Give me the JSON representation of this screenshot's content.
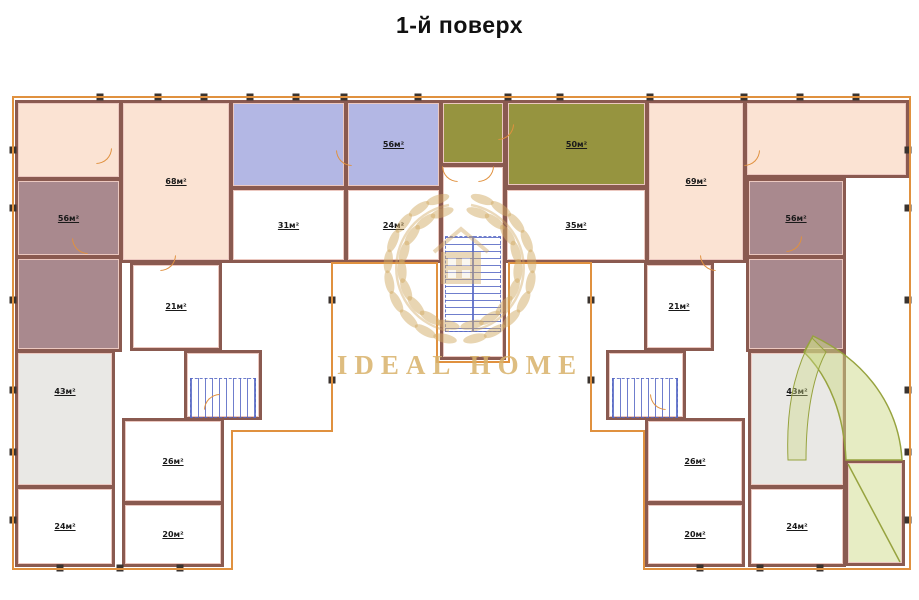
{
  "title": "1-й поверх",
  "watermark": {
    "text": "IDEAL HOME",
    "color": "#d7af68"
  },
  "palette": {
    "peach": "#fbe3d3",
    "blue": "#b3b7e4",
    "olive": "#96943f",
    "mauve": "#a9898e",
    "gray": "#e9e8e5",
    "white": "#ffffff",
    "terrace": "rgba(207,219,138,0.5)",
    "wall": "#8a5a50",
    "outline": "#e0913f",
    "stair_blue": "#5668c4"
  },
  "plan": {
    "rooms": [
      {
        "id": "room-peach-left-top",
        "label": "",
        "x": 15,
        "y": 100,
        "w": 107,
        "h": 80,
        "fill": "peach"
      },
      {
        "id": "room-68",
        "label": "68м²",
        "x": 120,
        "y": 100,
        "w": 112,
        "h": 163,
        "fill": "peach"
      },
      {
        "id": "room-blue-left",
        "label": "",
        "x": 230,
        "y": 100,
        "w": 117,
        "h": 89,
        "fill": "blue"
      },
      {
        "id": "room-56-blue",
        "label": "56м²",
        "x": 345,
        "y": 100,
        "w": 97,
        "h": 89,
        "fill": "blue"
      },
      {
        "id": "room-green-small",
        "label": "",
        "x": 440,
        "y": 100,
        "w": 66,
        "h": 66,
        "fill": "olive"
      },
      {
        "id": "room-50",
        "label": "50м²",
        "x": 505,
        "y": 100,
        "w": 143,
        "h": 88,
        "fill": "olive"
      },
      {
        "id": "room-69",
        "label": "69м²",
        "x": 646,
        "y": 100,
        "w": 100,
        "h": 163,
        "fill": "peach"
      },
      {
        "id": "room-peach-right-top",
        "label": "",
        "x": 744,
        "y": 100,
        "w": 165,
        "h": 78,
        "fill": "peach"
      },
      {
        "id": "room-31",
        "label": "31м²",
        "x": 230,
        "y": 187,
        "w": 117,
        "h": 76,
        "fill": "white"
      },
      {
        "id": "room-24-top",
        "label": "24м²",
        "x": 345,
        "y": 187,
        "w": 97,
        "h": 76,
        "fill": "white"
      },
      {
        "id": "room-35",
        "label": "35м²",
        "x": 504,
        "y": 187,
        "w": 144,
        "h": 76,
        "fill": "white"
      },
      {
        "id": "stair-hall-center",
        "label": "",
        "x": 440,
        "y": 164,
        "w": 66,
        "h": 196,
        "fill": "white"
      },
      {
        "id": "room-56-left",
        "label": "56м²",
        "x": 15,
        "y": 178,
        "w": 107,
        "h": 80,
        "fill": "mauve"
      },
      {
        "id": "room-mauve-left",
        "label": "",
        "x": 15,
        "y": 256,
        "w": 107,
        "h": 96,
        "fill": "mauve"
      },
      {
        "id": "room-43-left",
        "label": "43м²",
        "x": 15,
        "y": 350,
        "w": 100,
        "h": 138,
        "fill": "gray",
        "lt": 26
      },
      {
        "id": "room-24-left",
        "label": "24м²",
        "x": 15,
        "y": 486,
        "w": 100,
        "h": 81,
        "fill": "white"
      },
      {
        "id": "room-21-left",
        "label": "21м²",
        "x": 130,
        "y": 262,
        "w": 92,
        "h": 89,
        "fill": "white"
      },
      {
        "id": "stair-room-left",
        "label": "",
        "x": 184,
        "y": 350,
        "w": 78,
        "h": 70,
        "fill": "white"
      },
      {
        "id": "room-26-left",
        "label": "26м²",
        "x": 122,
        "y": 418,
        "w": 102,
        "h": 86,
        "fill": "white"
      },
      {
        "id": "room-20-left",
        "label": "20м²",
        "x": 122,
        "y": 502,
        "w": 102,
        "h": 65,
        "fill": "white"
      },
      {
        "id": "room-56-right",
        "label": "56м²",
        "x": 746,
        "y": 178,
        "w": 100,
        "h": 80,
        "fill": "mauve"
      },
      {
        "id": "room-mauve-right",
        "label": "",
        "x": 746,
        "y": 256,
        "w": 100,
        "h": 96,
        "fill": "mauve"
      },
      {
        "id": "room-43-right",
        "label": "43м²",
        "x": 748,
        "y": 350,
        "w": 98,
        "h": 138,
        "fill": "gray",
        "lt": 26
      },
      {
        "id": "room-24-right",
        "label": "24м²",
        "x": 748,
        "y": 486,
        "w": 98,
        "h": 81,
        "fill": "white"
      },
      {
        "id": "room-21-right",
        "label": "21м²",
        "x": 644,
        "y": 262,
        "w": 70,
        "h": 89,
        "fill": "white"
      },
      {
        "id": "stair-room-right",
        "label": "",
        "x": 606,
        "y": 350,
        "w": 80,
        "h": 70,
        "fill": "white"
      },
      {
        "id": "room-26-right",
        "label": "26м²",
        "x": 645,
        "y": 418,
        "w": 100,
        "h": 86,
        "fill": "white"
      },
      {
        "id": "room-20-right",
        "label": "20м²",
        "x": 645,
        "y": 502,
        "w": 100,
        "h": 65,
        "fill": "white"
      },
      {
        "id": "terrace-green",
        "label": "",
        "x": 845,
        "y": 460,
        "w": 60,
        "h": 106,
        "fill": "terrace"
      }
    ],
    "stairs": [
      {
        "id": "staircase-center",
        "x": 445,
        "y": 236,
        "w": 56,
        "h": 96,
        "dir": "v"
      },
      {
        "id": "staircase-left",
        "x": 190,
        "y": 378,
        "w": 66,
        "h": 40,
        "dir": "h"
      },
      {
        "id": "staircase-right",
        "x": 612,
        "y": 378,
        "w": 66,
        "h": 40,
        "dir": "h"
      }
    ],
    "doors": [
      {
        "x": 96,
        "y": 148,
        "rot": 0
      },
      {
        "x": 336,
        "y": 150,
        "rot": 90
      },
      {
        "x": 498,
        "y": 124,
        "rot": 0
      },
      {
        "x": 744,
        "y": 150,
        "rot": 0
      },
      {
        "x": 72,
        "y": 238,
        "rot": 90
      },
      {
        "x": 786,
        "y": 236,
        "rot": 0
      },
      {
        "x": 442,
        "y": 166,
        "rot": 90
      },
      {
        "x": 478,
        "y": 166,
        "rot": 0
      },
      {
        "x": 204,
        "y": 394,
        "rot": 180
      },
      {
        "x": 650,
        "y": 394,
        "rot": 90
      },
      {
        "x": 160,
        "y": 255,
        "rot": 0
      },
      {
        "x": 700,
        "y": 255,
        "rot": 90
      }
    ],
    "piers": [
      [
        100,
        97
      ],
      [
        158,
        97
      ],
      [
        204,
        97
      ],
      [
        250,
        97
      ],
      [
        296,
        97
      ],
      [
        344,
        97
      ],
      [
        418,
        97
      ],
      [
        508,
        97
      ],
      [
        560,
        97
      ],
      [
        650,
        97
      ],
      [
        744,
        97
      ],
      [
        800,
        97
      ],
      [
        856,
        97
      ],
      [
        13,
        150
      ],
      [
        13,
        208
      ],
      [
        13,
        300
      ],
      [
        13,
        390
      ],
      [
        13,
        452
      ],
      [
        13,
        520
      ],
      [
        908,
        150
      ],
      [
        908,
        208
      ],
      [
        908,
        300
      ],
      [
        908,
        390
      ],
      [
        908,
        452
      ],
      [
        908,
        520
      ],
      [
        60,
        568
      ],
      [
        120,
        568
      ],
      [
        180,
        568
      ],
      [
        700,
        568
      ],
      [
        760,
        568
      ],
      [
        820,
        568
      ],
      [
        332,
        300
      ],
      [
        332,
        380
      ],
      [
        591,
        300
      ],
      [
        591,
        380
      ]
    ]
  }
}
